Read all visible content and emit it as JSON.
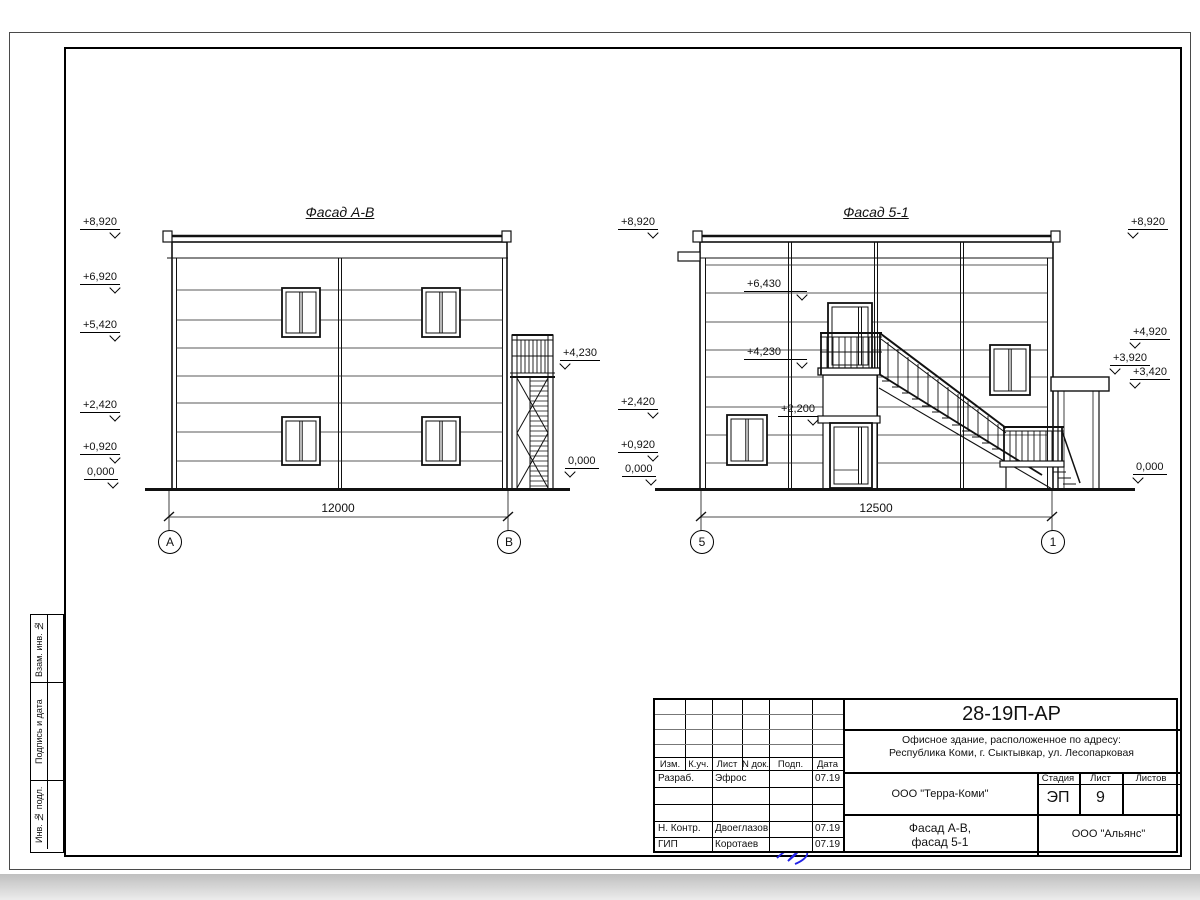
{
  "sheet": {
    "side_labels": [
      "Взам. инв. №",
      "Подпись и дата",
      "Инв. № подл."
    ]
  },
  "facade_ab": {
    "title": "Фасад А-В",
    "dim": "12000",
    "axis_left": "А",
    "axis_right": "В",
    "elev_left": [
      "+8,920",
      "+6,920",
      "+5,420",
      "+2,420",
      "+0,920",
      "0,000"
    ],
    "elev_right": [
      "+4,230",
      "0,000"
    ]
  },
  "facade_51": {
    "title": "Фасад 5-1",
    "dim": "12500",
    "axis_left": "5",
    "axis_right": "1",
    "elev_left": [
      "+8,920",
      "+2,420",
      "+0,920",
      "0,000"
    ],
    "elev_inner": [
      "+6,430",
      "+4,230",
      "+2,200"
    ],
    "elev_right": [
      "+8,920",
      "+4,920",
      "+3,920",
      "+3,420",
      "0,000"
    ]
  },
  "stamp": {
    "doc_number": "28-19П-АР",
    "object_line1": "Офисное здание, расположенное по адресу:",
    "object_line2": "Республика Коми, г. Сыктывкар, ул. Лесопарковая",
    "org_design": "ООО \"Терра-Коми\"",
    "drawing_title_line1": "Фасад А-В,",
    "drawing_title_line2": "фасад 5-1",
    "org_build": "ООО \"Альянс\"",
    "stage_label": "Стадия",
    "list_label": "Лист",
    "listov_label": "Листов",
    "stage": "ЭП",
    "list_no": "9",
    "sheets_total": "",
    "head_cols": [
      "Изм.",
      "К.уч.",
      "Лист",
      "N док.",
      "Подп.",
      "Дата"
    ],
    "sign_rows": [
      {
        "role": "Разраб.",
        "name": "Эфрос",
        "date": "07.19"
      },
      {
        "role": "Н. Контр.",
        "name": "Двоеглазов",
        "date": "07.19"
      },
      {
        "role": "ГИП",
        "name": "Коротаев",
        "date": "07.19"
      }
    ]
  }
}
